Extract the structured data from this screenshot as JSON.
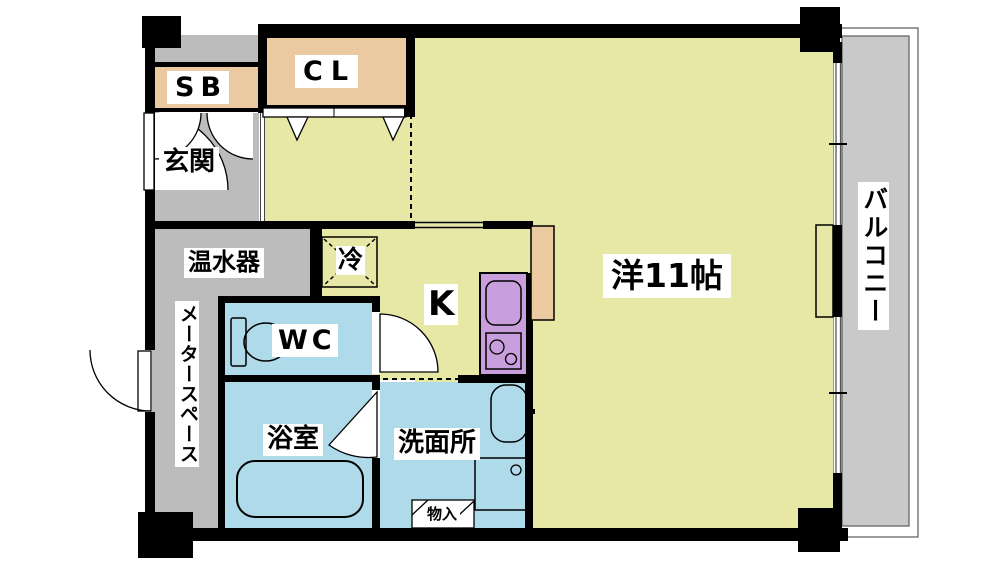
{
  "title": "apartment-floor-plan",
  "colors": {
    "room": "#e7e8a5",
    "tan": "#ebcaa1",
    "blue": "#aedae9",
    "purple": "#c89fdc",
    "gray_area": "#bcbcbc",
    "balcony_gray": "#c9c9c9",
    "wall": "#000000"
  },
  "rooms": {
    "main_room": {
      "label": "洋11帖"
    },
    "kitchen": {
      "label": "K"
    },
    "closet": {
      "label": "CL"
    },
    "shoe_box": {
      "label": "SB"
    },
    "entrance": {
      "label": "玄関"
    },
    "water_heater": {
      "label": "温水器"
    },
    "meter_space": {
      "label": "メータースペース"
    },
    "refrigerator": {
      "label": "冷"
    },
    "toilet": {
      "label": "WC"
    },
    "bathroom": {
      "label": "浴室"
    },
    "washroom": {
      "label": "洗面所"
    },
    "storage": {
      "label": "物入"
    },
    "balcony": {
      "label": "バルコニー"
    }
  }
}
